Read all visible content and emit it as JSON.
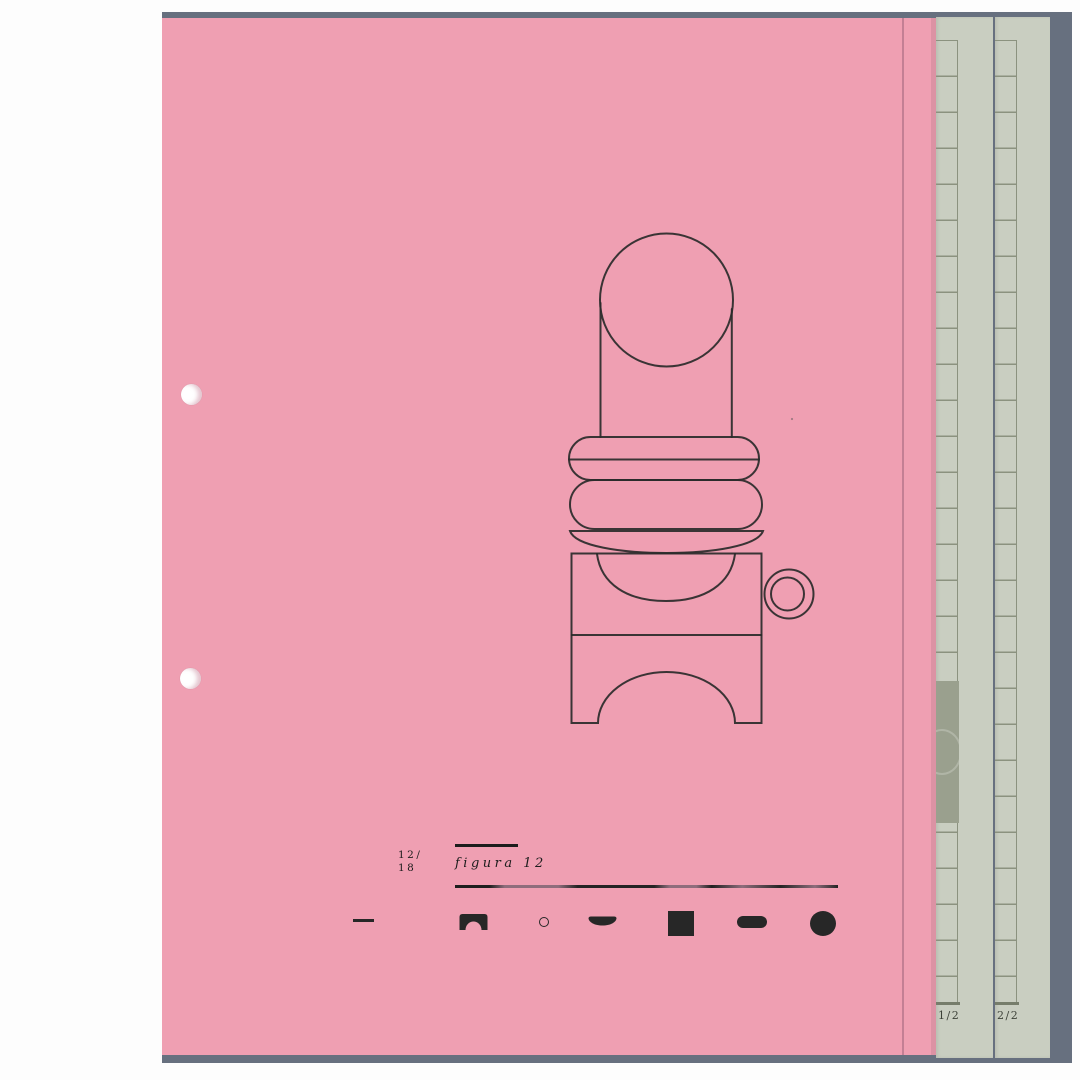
{
  "caption": {
    "index_line1": "12/",
    "index_line2": "18",
    "title": "figura 12"
  },
  "legend": {
    "shapes": [
      "dash",
      "arch",
      "ring",
      "dish",
      "square",
      "pill",
      "dot"
    ]
  },
  "side_pages": [
    {
      "label": "1/2"
    },
    {
      "label": "2/2"
    }
  ],
  "colors": {
    "page_pink": "#ef9fb2",
    "backdrop_slate": "#67707f",
    "strip_sage": "#c9cec1",
    "grid_line": "#8b927f",
    "dark_patch": "#9aa08e",
    "ink": "#272727",
    "label_ink": "#3c4138"
  }
}
